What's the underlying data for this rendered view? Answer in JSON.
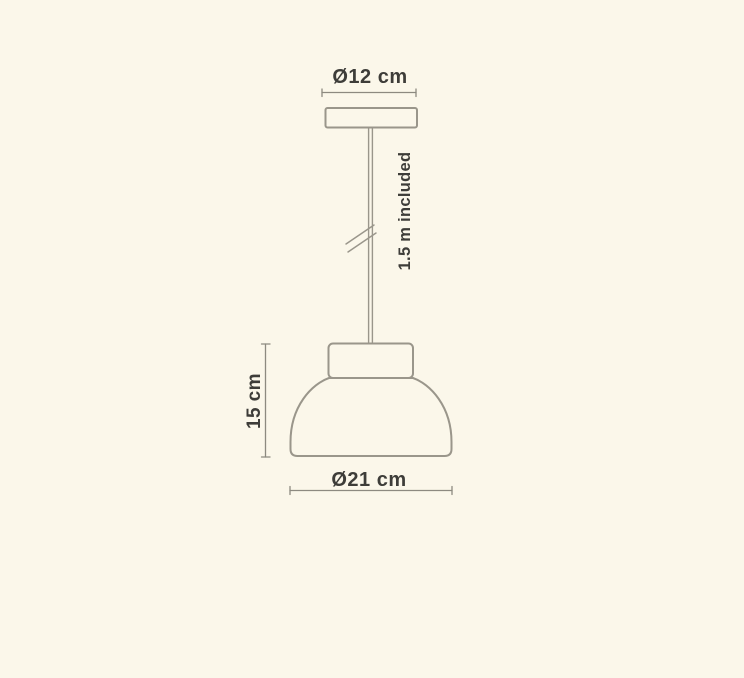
{
  "diagram": {
    "labels": {
      "canopy_diameter": "Ø12 cm",
      "cable_length": "1.5 m included",
      "shade_height": "15 cm",
      "shade_diameter": "Ø21 cm"
    },
    "colors": {
      "background": "#fbf7ea",
      "outline": "#9a968b",
      "dimension_line": "#8d8a80",
      "text": "#3e3d39"
    }
  }
}
